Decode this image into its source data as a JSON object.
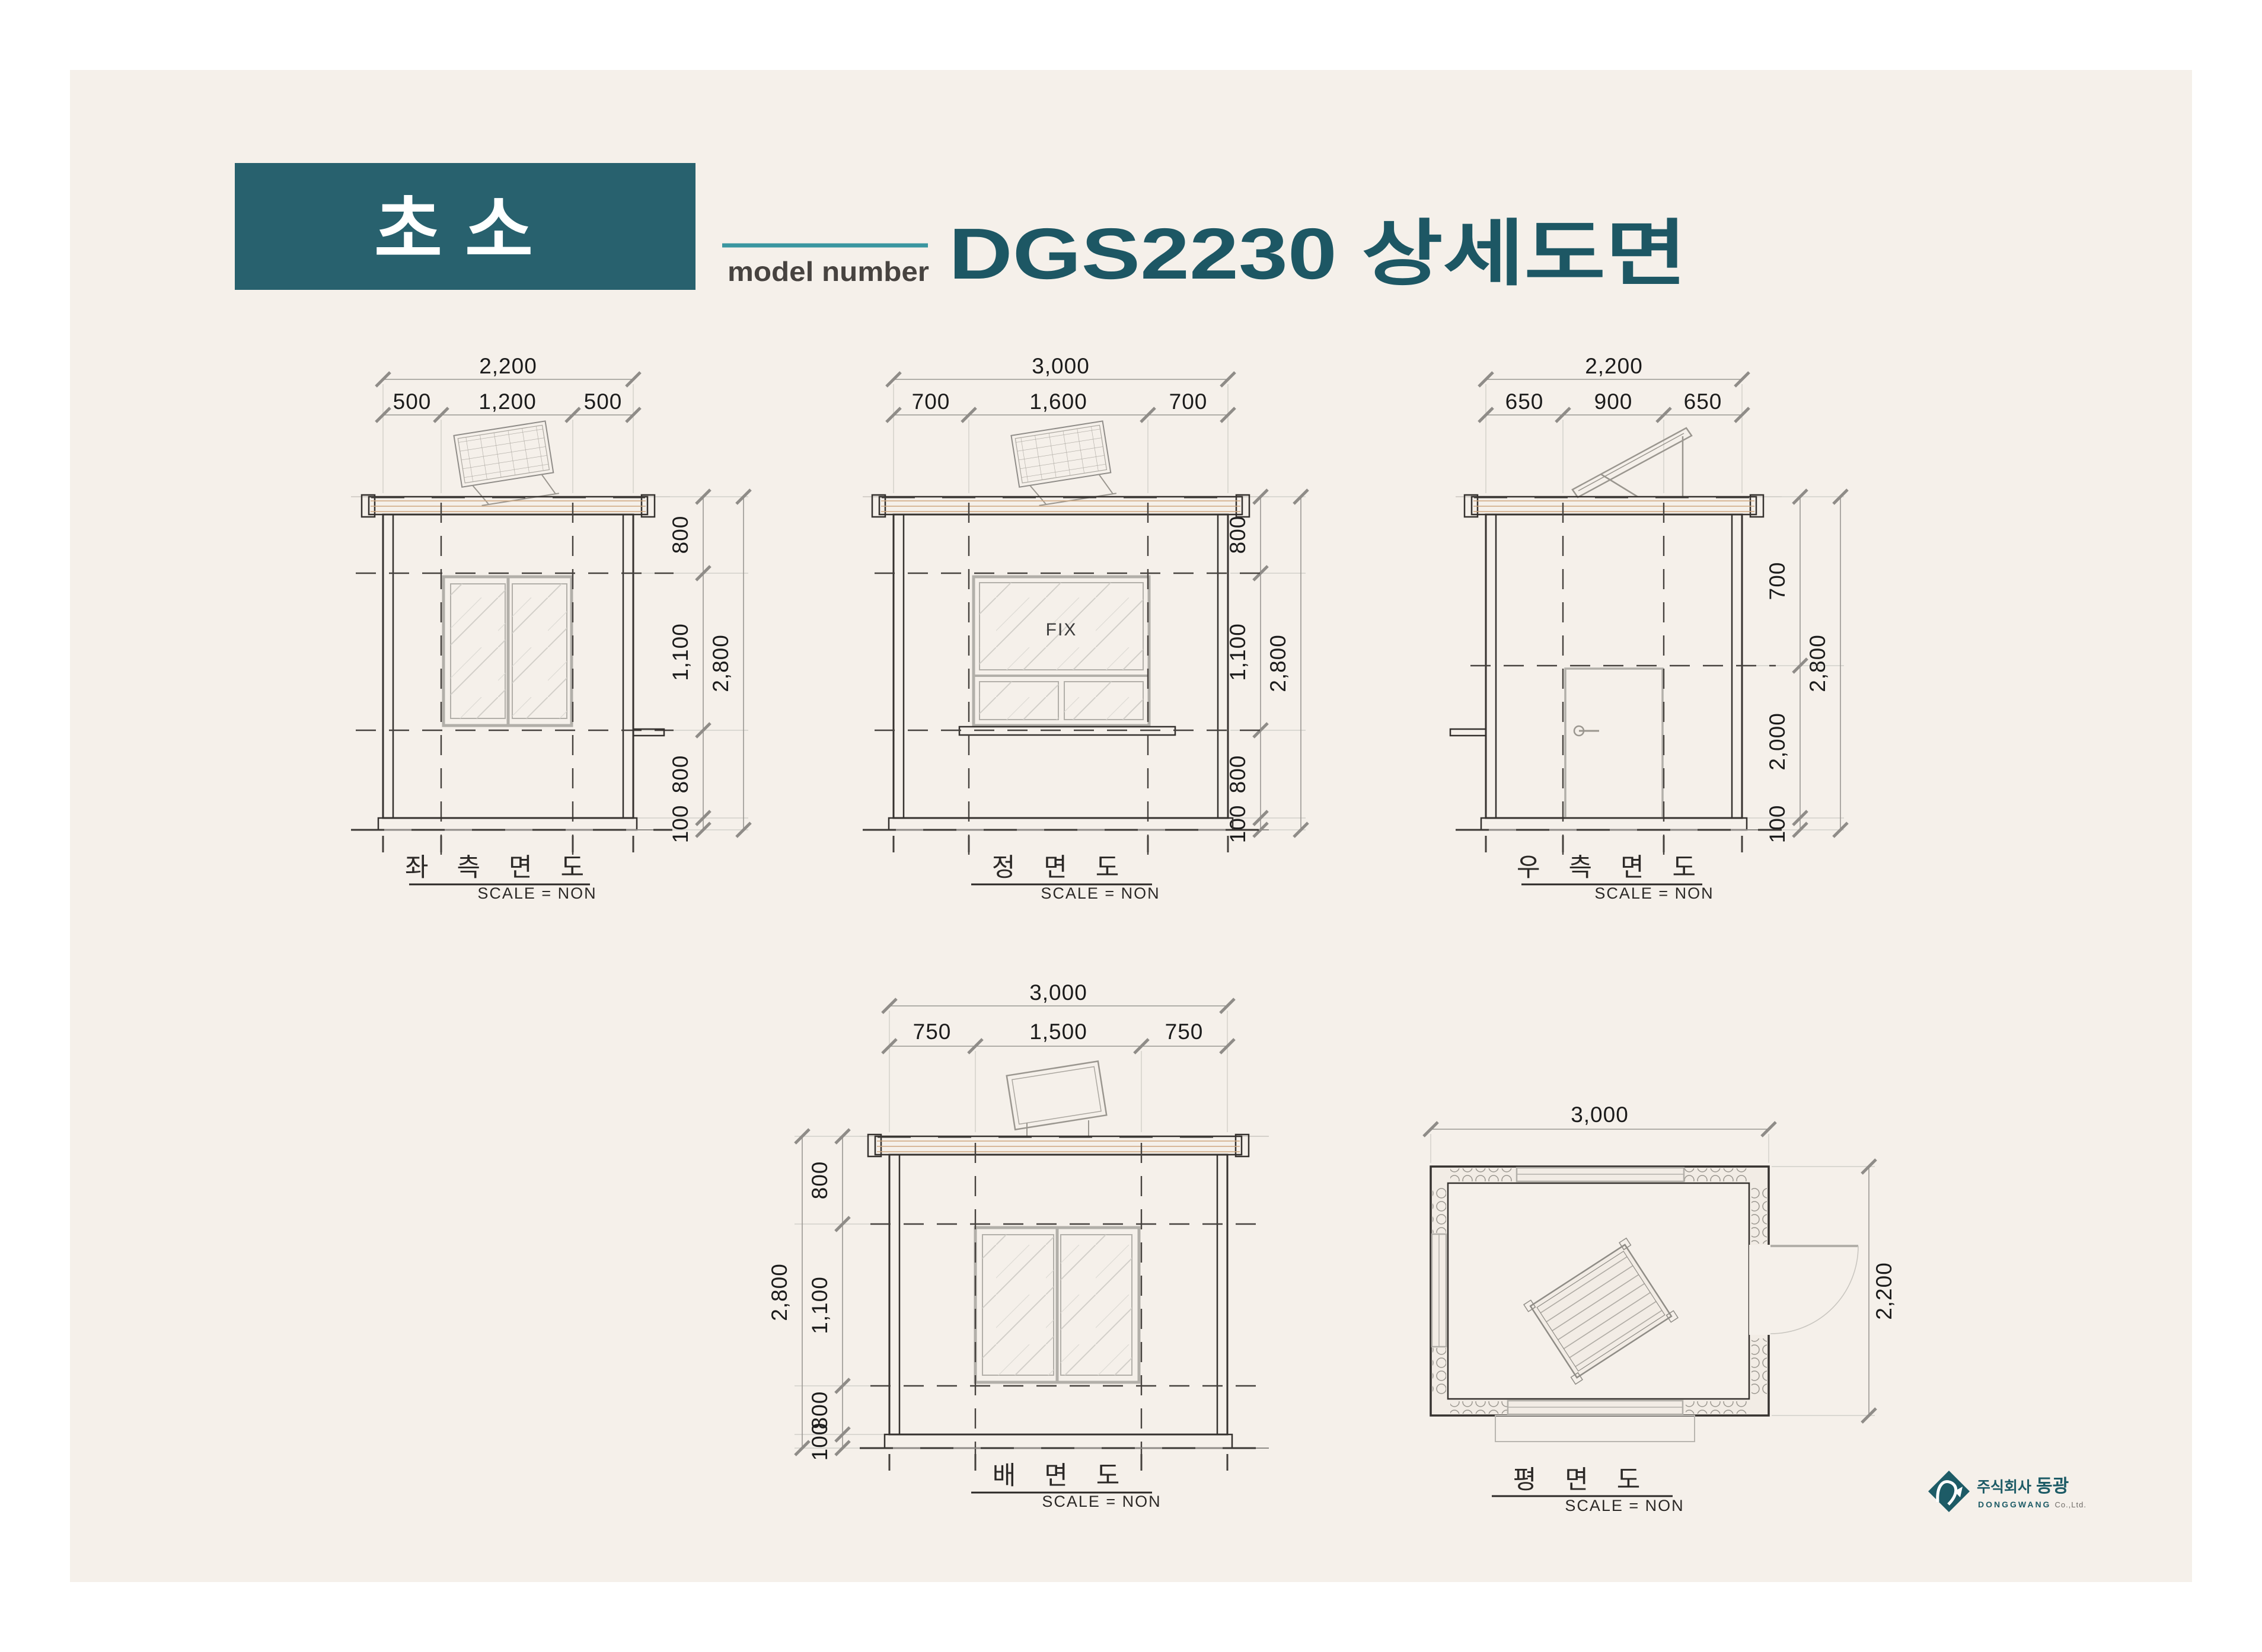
{
  "header": {
    "badge": "초소",
    "model_label": "model number",
    "title": "DGS2230 상세도면"
  },
  "views": {
    "left": {
      "title": "좌 측 면 도",
      "scale": "SCALE = NON",
      "dims": {
        "total_w": "2,200",
        "segs_w": [
          "500",
          "1,200",
          "500"
        ],
        "segs_h": [
          "800",
          "1,100",
          "800",
          "100"
        ],
        "total_h": "2,800"
      }
    },
    "front": {
      "title": "정 면 도",
      "scale": "SCALE = NON",
      "window_label": "FIX",
      "dims": {
        "total_w": "3,000",
        "segs_w": [
          "700",
          "1,600",
          "700"
        ],
        "segs_h": [
          "800",
          "1,100",
          "800",
          "100"
        ],
        "total_h": "2,800"
      }
    },
    "right": {
      "title": "우 측 면 도",
      "scale": "SCALE = NON",
      "dims": {
        "total_w": "2,200",
        "segs_w": [
          "650",
          "900",
          "650"
        ],
        "segs_h": [
          "700",
          "2,000",
          "100"
        ],
        "total_h": "2,800"
      }
    },
    "rear": {
      "title": "배 면 도",
      "scale": "SCALE = NON",
      "dims": {
        "total_w": "3,000",
        "segs_w": [
          "750",
          "1,500",
          "750"
        ],
        "segs_h": [
          "800",
          "1,100",
          "800",
          "100"
        ],
        "total_h": "2,800"
      }
    },
    "plan": {
      "title": "평 면 도",
      "scale": "SCALE = NON",
      "dims": {
        "width": "3,000",
        "depth": "2,200"
      }
    }
  },
  "logo": {
    "kr_prefix": "주식회사",
    "kr_name": "동광",
    "en_name": "DONGGWANG",
    "en_suffix": "Co.,Ltd."
  },
  "colors": {
    "teal_box": "#28616e",
    "accent_line": "#3a96a0",
    "title_teal": "#1d5764",
    "sheet_cream": "#f5f0ea",
    "siding_stripe": "#d9ab80"
  }
}
